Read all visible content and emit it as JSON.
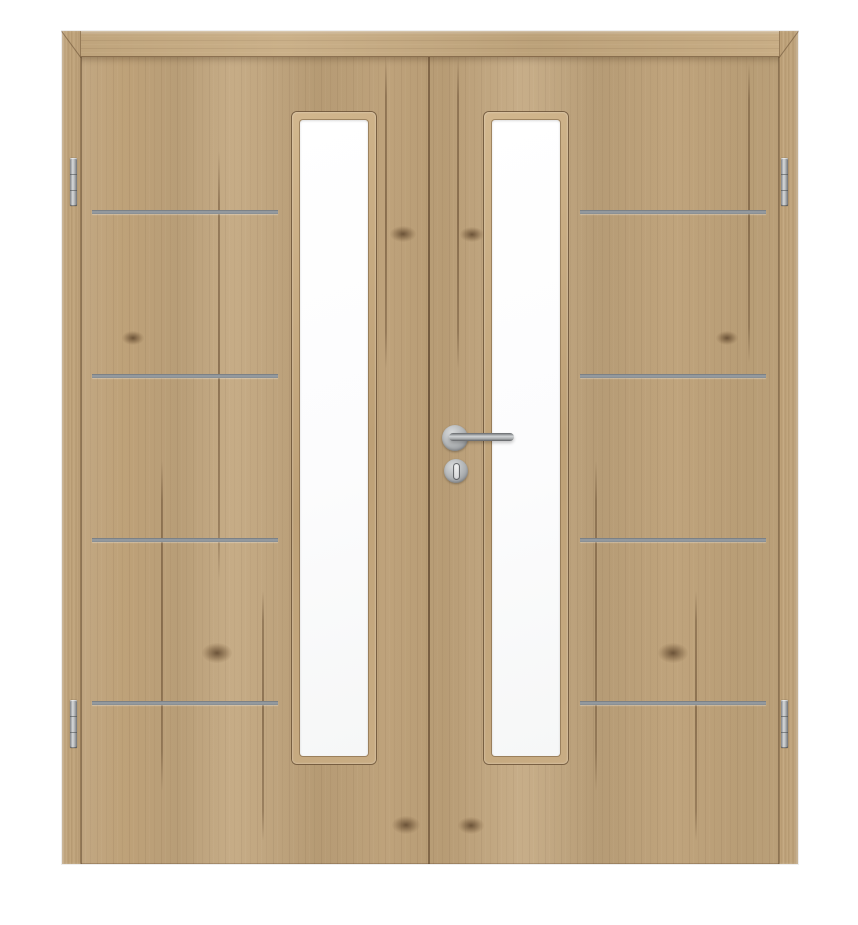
{
  "scene": {
    "description": "Product photo of a double interior door in light oak laminate; each leaf has a tall narrow frosted glass cutout near the meeting stiles, four horizontal stainless-steel inlay strips on the hinge side, two hinges per leaf, and a stainless lever handle with key rosette on the right (active) leaf.",
    "background_color": "#ffffff",
    "wood": {
      "base_color": "#c0a379",
      "light_color": "#cdb289",
      "dark_grain_color": "#8a7152",
      "edge_line_color": "#6f5a3e",
      "grain_lines": [
        {
          "x": 156,
          "y": 120,
          "h": 430
        },
        {
          "x": 99,
          "y": 430,
          "h": 330
        },
        {
          "x": 200,
          "y": 560,
          "h": 250
        },
        {
          "x": 323,
          "y": 28,
          "h": 310
        },
        {
          "x": 395,
          "y": 28,
          "h": 310
        },
        {
          "x": 686,
          "y": 32,
          "h": 300
        },
        {
          "x": 633,
          "y": 560,
          "h": 250
        },
        {
          "x": 533,
          "y": 430,
          "h": 330
        }
      ],
      "knots": [
        {
          "cx": 341,
          "cy": 203,
          "w": 26,
          "h": 16
        },
        {
          "cx": 410,
          "cy": 203,
          "w": 24,
          "h": 15
        },
        {
          "cx": 344,
          "cy": 794,
          "w": 28,
          "h": 18
        },
        {
          "cx": 409,
          "cy": 794,
          "w": 26,
          "h": 17
        },
        {
          "cx": 155,
          "cy": 622,
          "w": 30,
          "h": 20
        },
        {
          "cx": 611,
          "cy": 622,
          "w": 30,
          "h": 20
        },
        {
          "cx": 71,
          "cy": 307,
          "w": 22,
          "h": 14
        },
        {
          "cx": 665,
          "cy": 307,
          "w": 22,
          "h": 14
        }
      ]
    },
    "frame": {
      "x": 62,
      "y": 31,
      "width": 736,
      "height": 833,
      "head_height": 26,
      "jamb_width": 19
    },
    "leaves": {
      "count": 2,
      "gap_x": 366,
      "top": 26,
      "height": 807
    },
    "glass": {
      "color": "#ffffff",
      "bevel_color": "#c9ad84",
      "outline_color": "#6c5438",
      "inset": 8,
      "panels": [
        {
          "x": 230,
          "y": 81,
          "w": 84,
          "h": 652
        },
        {
          "x": 422,
          "y": 81,
          "w": 84,
          "h": 652
        }
      ]
    },
    "strips": {
      "count_per_leaf": 4,
      "color": "#949aa0",
      "height": 4,
      "y_tops": [
        179,
        343,
        507,
        670
      ],
      "spans": [
        {
          "x": 30,
          "w": 186
        },
        {
          "x": 518,
          "w": 186
        }
      ]
    },
    "hinges": {
      "count": 4,
      "color": "#b9bcbe",
      "width": 7,
      "height": 48,
      "positions": [
        {
          "x": 8,
          "y": 127
        },
        {
          "x": 8,
          "y": 669
        },
        {
          "x": 719,
          "y": 127
        },
        {
          "x": 719,
          "y": 669
        }
      ]
    },
    "handle": {
      "metal_color": "#a8abae",
      "rosette": {
        "cx": 393,
        "cy": 407,
        "r": 13
      },
      "lever": {
        "x": 387,
        "y": 402,
        "length": 65,
        "thickness": 8
      },
      "key_rosette": {
        "cx": 394,
        "cy": 440,
        "r": 12
      },
      "keyhole": {
        "w": 5,
        "h": 15
      }
    }
  }
}
